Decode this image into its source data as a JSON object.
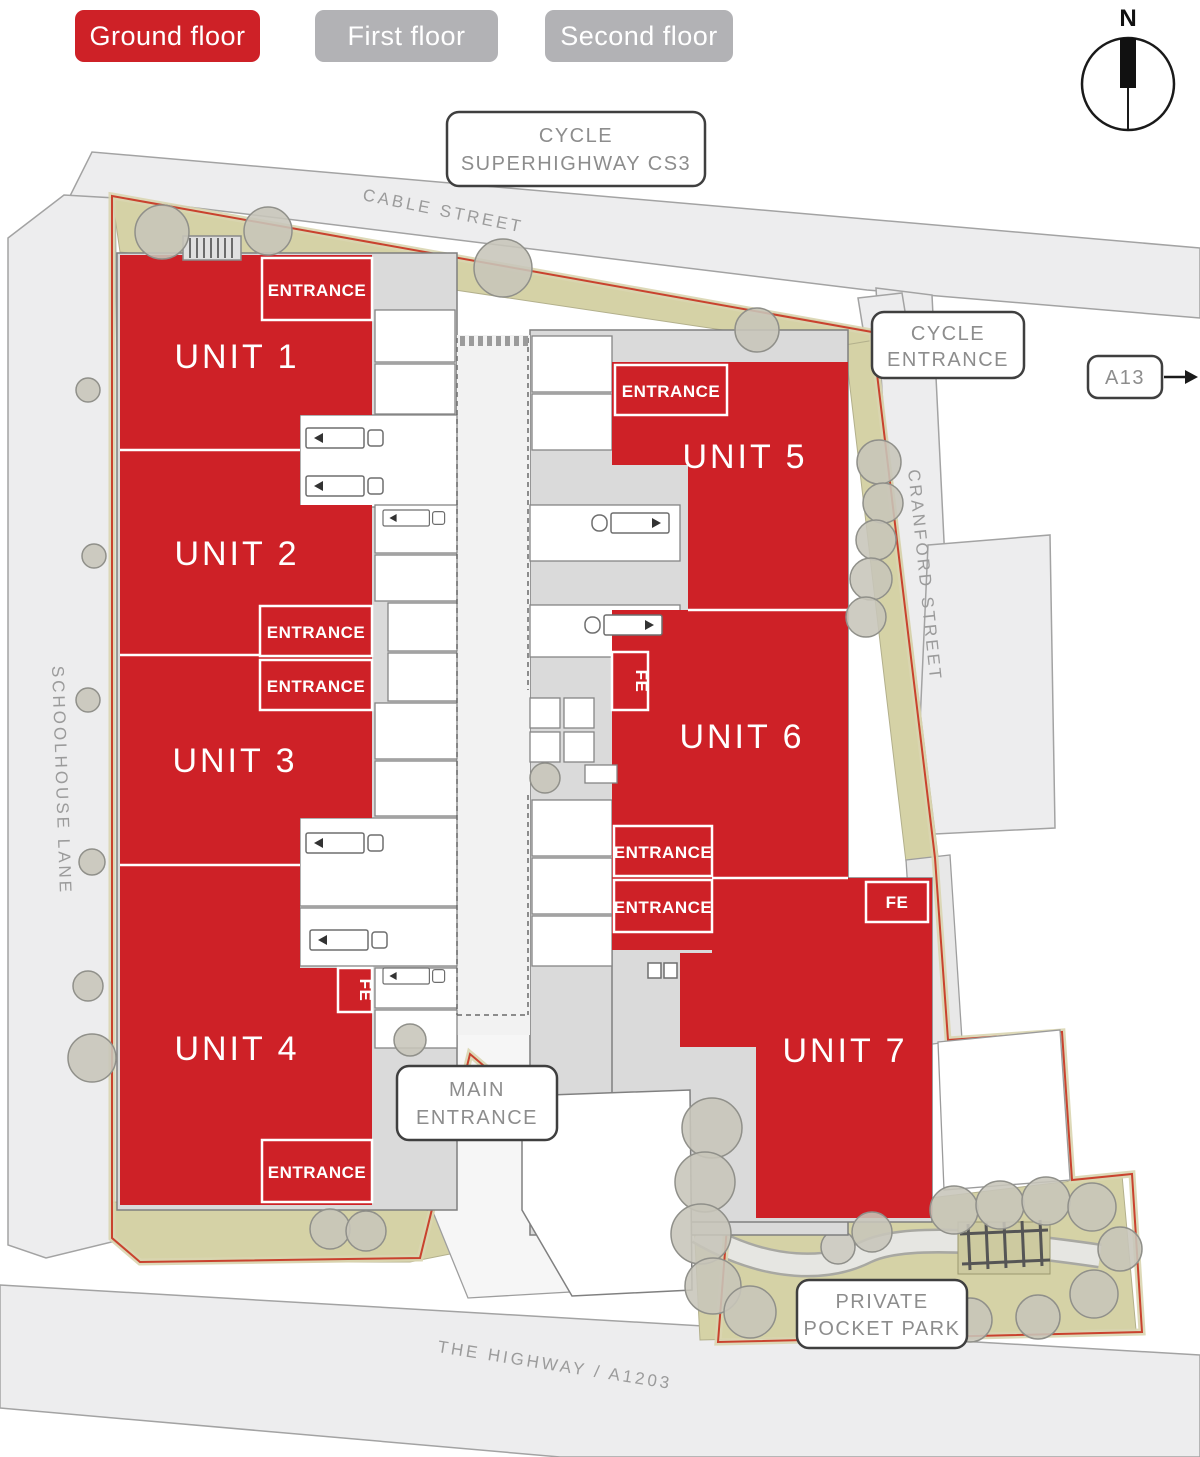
{
  "floor_tabs": [
    {
      "label": "Ground floor",
      "active": true
    },
    {
      "label": "First floor",
      "active": false
    },
    {
      "label": "Second floor",
      "active": false
    }
  ],
  "compass": {
    "label": "N"
  },
  "streets": {
    "cable": "CABLE STREET",
    "schoolhouse": "SCHOOLHOUSE LANE",
    "cranford": "CRANFORD STREET",
    "highway": "THE HIGHWAY / A1203"
  },
  "callouts": {
    "cycle_superhighway": {
      "line1": "CYCLE",
      "line2": "SUPERHIGHWAY CS3"
    },
    "cycle_entrance": {
      "line1": "CYCLE",
      "line2": "ENTRANCE"
    },
    "a13": {
      "label": "A13"
    },
    "main_entrance": {
      "line1": "MAIN",
      "line2": "ENTRANCE"
    },
    "pocket_park": {
      "line1": "PRIVATE",
      "line2": "POCKET PARK"
    }
  },
  "units": [
    {
      "label": "UNIT 1"
    },
    {
      "label": "UNIT 2"
    },
    {
      "label": "UNIT 3"
    },
    {
      "label": "UNIT 4"
    },
    {
      "label": "UNIT 5"
    },
    {
      "label": "UNIT 6"
    },
    {
      "label": "UNIT 7"
    }
  ],
  "labels": {
    "entrance": "ENTRANCE",
    "fire_exit": "FE"
  },
  "colors": {
    "unit_red": "#ce2127",
    "tab_inactive_gray": "#b2b2b5",
    "street_fill": "#ededee",
    "landscape_olive": "#d5d2a6",
    "tree_gray": "#c7c5ba",
    "callout_text_gray": "#8d8d8d",
    "boundary_red": "#c9422e"
  }
}
